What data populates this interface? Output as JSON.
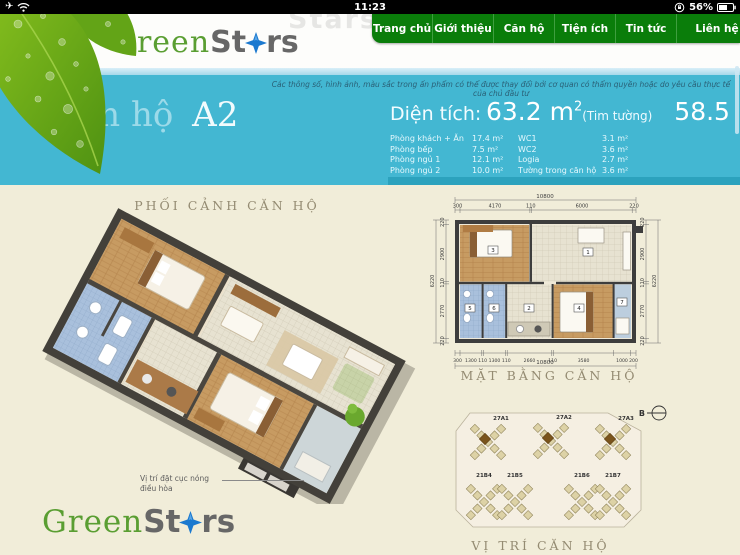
{
  "status_bar": {
    "time": "11:23",
    "battery_percent": "56%"
  },
  "header": {
    "watermark": "Stars",
    "logo": {
      "part1": "Green",
      "part2": "St",
      "part3": "rs"
    }
  },
  "nav": {
    "items": [
      {
        "label": "Trang chủ"
      },
      {
        "label": "Giới thiệu"
      },
      {
        "label": "Căn hộ"
      },
      {
        "label": "Tiện ích"
      },
      {
        "label": "Tin tức"
      },
      {
        "label": "Liên hệ"
      }
    ]
  },
  "hero": {
    "disclaimer": "Các thông số, hình ảnh, màu sắc trong ấn phẩm có thể được thay đổi bởi cơ quan có thẩm quyền hoặc do yêu cầu thực tế của chủ đầu tư",
    "title": {
      "prefix": "Căn hộ",
      "unit": "A2"
    },
    "specs": {
      "area_label": "Diện tích:",
      "areas": [
        {
          "value": "63.2 m",
          "sup": "2",
          "note": "(Tim tường)"
        },
        {
          "value": "58.5 m",
          "sup": "2",
          "note": "(Thông thủy)"
        }
      ],
      "rows": [
        {
          "l1": "Phòng khách + Ăn",
          "v1": "17.4 m²",
          "l2": "WC1",
          "v2": "3.1 m²"
        },
        {
          "l1": "Phòng bếp",
          "v1": "7.5 m²",
          "l2": "WC2",
          "v2": "3.6 m²"
        },
        {
          "l1": "Phòng ngủ 1",
          "v1": "12.1 m²",
          "l2": "Logia",
          "v2": "2.7 m²"
        },
        {
          "l1": "Phòng ngủ 2",
          "v1": "10.0 m²",
          "l2": "Tường trong căn hộ",
          "v2": "3.6 m²"
        }
      ]
    }
  },
  "sections": {
    "perspective": "PHỐI CẢNH CĂN HỘ",
    "floorplan": "MẶT BẰNG CĂN HỘ",
    "location": "VỊ TRÍ CĂN HỘ"
  },
  "plan3d": {
    "ac_note_line1": "Vị trí đặt cục nóng",
    "ac_note_line2": "điều hòa"
  },
  "plan2d": {
    "total_top": "10800",
    "total_bottom": "10800",
    "total_left": "6220",
    "total_right": "6220",
    "dims_top": [
      "300",
      "4170",
      "110",
      "6000",
      "220"
    ],
    "dims_left": [
      "220",
      "2900",
      "110",
      "2770",
      "220"
    ],
    "dims_right": [
      "220",
      "2900",
      "110",
      "2770",
      "220"
    ],
    "dims_bottom": [
      "300",
      "1300",
      "110",
      "1300",
      "110",
      "2660",
      "110",
      "3580",
      "1000",
      "200"
    ],
    "rooms": [
      "1",
      "2",
      "3",
      "4",
      "5",
      "6",
      "7"
    ]
  },
  "siteplan": {
    "compass": "B",
    "top_buildings": [
      "27A1",
      "27A2",
      "27A3"
    ],
    "bottom_buildings": [
      "21B4",
      "21B5",
      "21B6",
      "21B7"
    ]
  },
  "footer_logo": {
    "part1": "Green",
    "part2": "St",
    "part3": "rs"
  },
  "colors": {
    "accent_cyan": "#43b7d2",
    "nav_green": "#0a7d0a",
    "logo_green": "#5a9e32",
    "star_blue": "#1b79cf"
  }
}
